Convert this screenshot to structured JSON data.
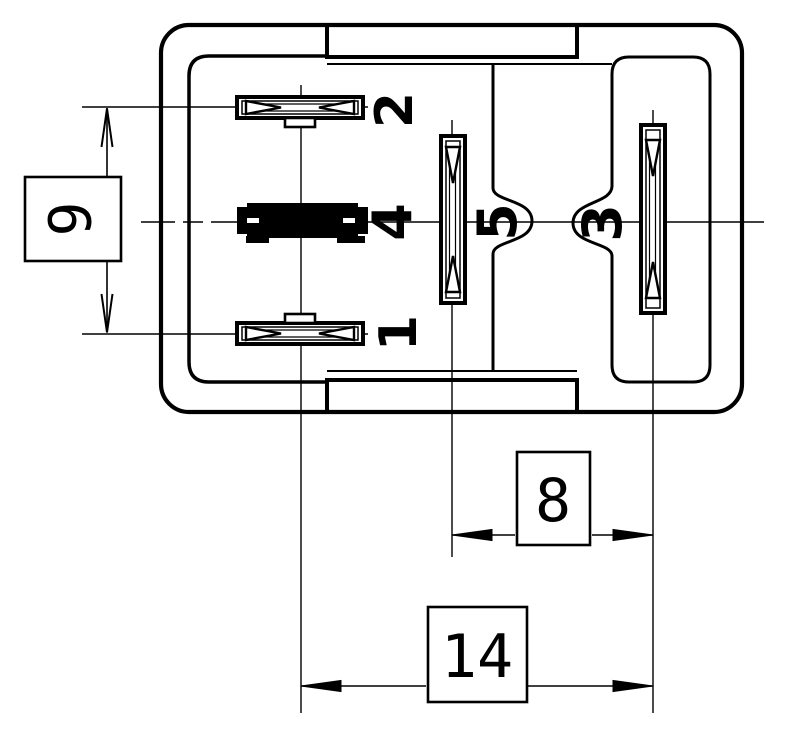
{
  "drawing": {
    "description": "Relay socket footprint technical drawing, bottom view, with blade terminals and dimension callouts",
    "units_note": "dimension values as printed",
    "pins": [
      {
        "id": "pin-2",
        "label": "2"
      },
      {
        "id": "pin-1",
        "label": "1"
      },
      {
        "id": "pin-4",
        "label": "4"
      },
      {
        "id": "pin-5",
        "label": "5"
      },
      {
        "id": "pin-3",
        "label": "3"
      }
    ],
    "dimensions": [
      {
        "id": "dim-9",
        "value": "9"
      },
      {
        "id": "dim-8",
        "value": "8"
      },
      {
        "id": "dim-14",
        "value": "14"
      }
    ],
    "colors": {
      "line": "#000000",
      "background": "#ffffff"
    }
  }
}
